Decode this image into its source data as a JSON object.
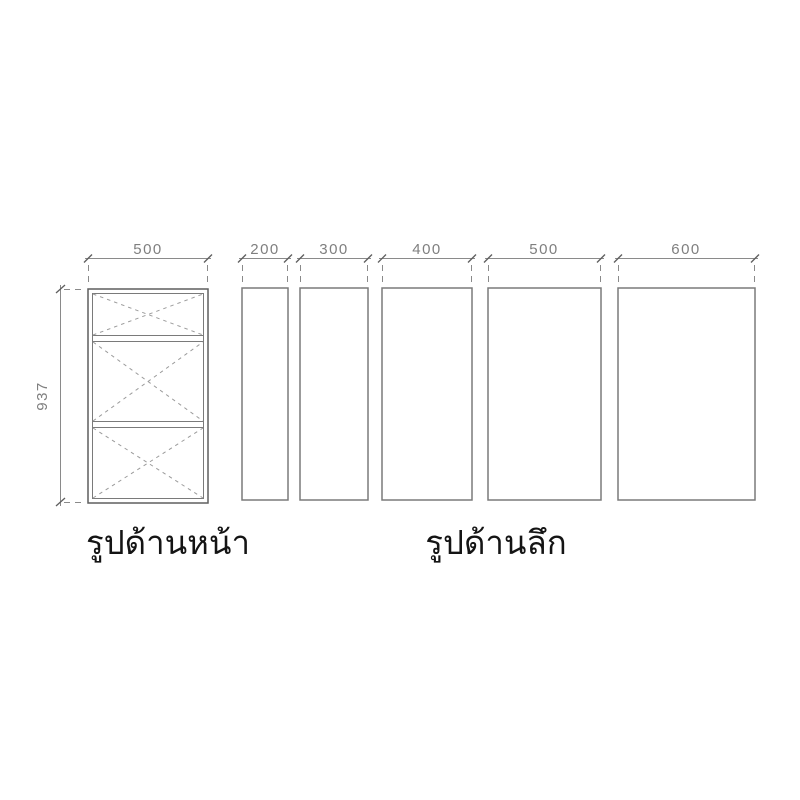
{
  "front_view": {
    "label": "รูปด้านหน้า",
    "width_label": "500",
    "height_label": "937"
  },
  "depth_view": {
    "label": "รูปด้านลึก",
    "depth_labels": [
      "200",
      "300",
      "400",
      "500",
      "600"
    ]
  },
  "colors": {
    "outline_dark": "#5f5f5f",
    "outline": "#7a7a7a",
    "dimension": "#8a8a8a",
    "dashed_cross": "#9b9b9b",
    "label_text": "#141414",
    "dim_text": "#7f7f7f",
    "background": "#ffffff"
  }
}
